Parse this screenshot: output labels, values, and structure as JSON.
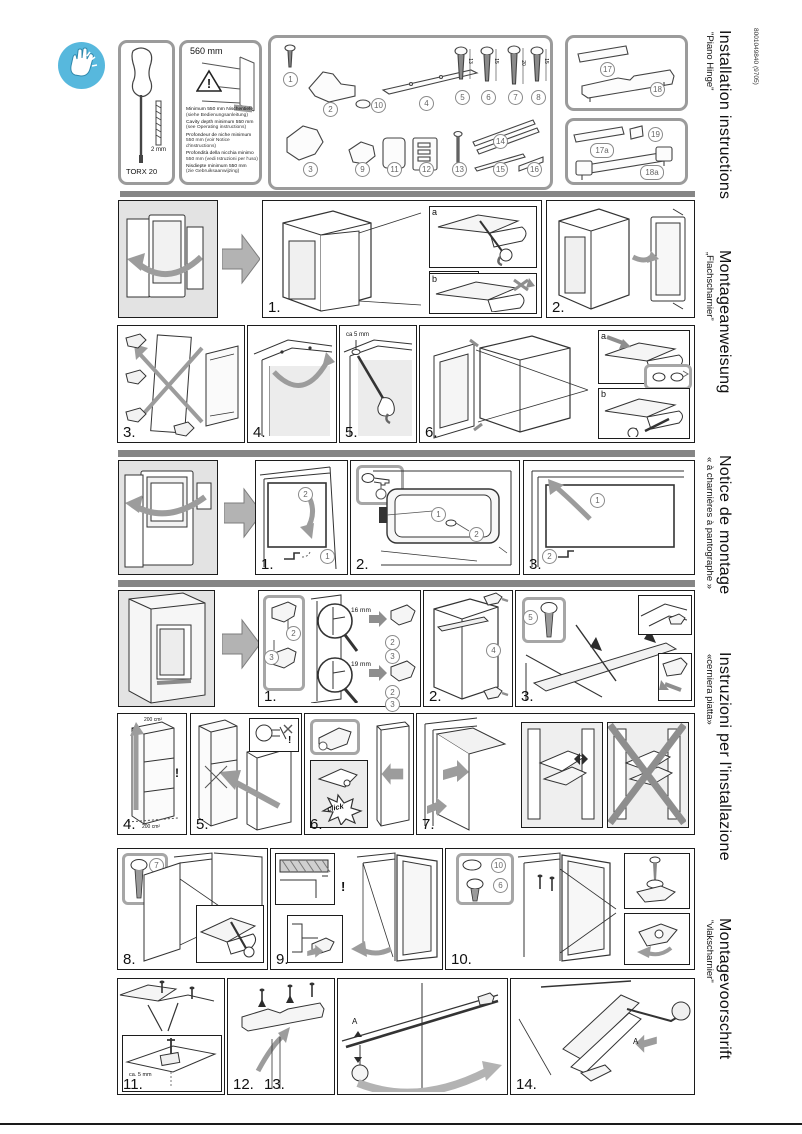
{
  "doc_code": "8001049840 (9705)",
  "languages": [
    {
      "title": "Installation instructions",
      "subtitle": "\"Piano Hinge\""
    },
    {
      "title": "Montageanweisung",
      "subtitle": "„Flachscharnier”"
    },
    {
      "title": "Notice de montage",
      "subtitle": "« à charnières à pantographe »"
    },
    {
      "title": "Instruzioni per l'installazione",
      "subtitle": "«cerniera piatta»"
    },
    {
      "title": "Montagevoorschrift",
      "subtitle": "\"vlakscharnier\""
    }
  ],
  "tool_panel": {
    "tool": "TORX 20",
    "bit": "2 mm"
  },
  "cavity_panel": {
    "dimension": "560 mm",
    "warning": "!",
    "requirements": [
      {
        "text": "Minimum 550 mm Nischentiefe",
        "note": "(siehe Bedienungsanleitung)"
      },
      {
        "text": "Cavity depth minimum 550 mm",
        "note": "(see Operating instructions)"
      },
      {
        "text": "Profondeur de niche minimum",
        "note": "550 mm (voir Notice d'instructions)"
      },
      {
        "text": "Profondità della nicchia minimo",
        "note": "550 mm (vedi Istruzioni per l'uso)"
      },
      {
        "text": "Nisdiepte minimum 550 mm",
        "note": "(zie Gebruiksaanwijzing)"
      }
    ]
  },
  "parts": {
    "p1": "1",
    "p2": "2",
    "p3": "3",
    "p4": "4",
    "p9": "9",
    "p10": "10",
    "p11": "11",
    "p12": "12",
    "p13": "13",
    "p14": "14",
    "p15": "15",
    "p16": "16",
    "screws": [
      {
        "no": "5",
        "len": "13"
      },
      {
        "no": "6",
        "len": "15"
      },
      {
        "no": "7",
        "len": "20"
      },
      {
        "no": "8",
        "len": "15"
      }
    ],
    "p17": "17",
    "p18": "18",
    "p17a": "17a",
    "p19": "19",
    "p18a": "18a"
  },
  "row1": {
    "step1": "1.",
    "step2": "2.",
    "inset_a": "a",
    "inset_b": "b",
    "check": "✓",
    "cross": "✗"
  },
  "row2": {
    "step3": "3.",
    "step4": "4.",
    "step5": "5.",
    "gap": "ca 5 mm",
    "step6": "6.",
    "inset_a": "a",
    "inset_b": "b"
  },
  "row3": {
    "step1": "1.",
    "step2": "2.",
    "step3": "3.",
    "ref1": "1",
    "ref2": "2"
  },
  "row4": {
    "step1": "1.",
    "step2": "2.",
    "step3": "3.",
    "dim16": "16 mm",
    "dim19": "19 mm",
    "ref2": "2",
    "ref3": "3",
    "ref4": "4",
    "ref5": "5"
  },
  "row5": {
    "step4": "4.",
    "step5": "5.",
    "step6": "6.",
    "step7": "7.",
    "area": "200 cm²",
    "warning": "!",
    "click": "click"
  },
  "row6": {
    "step8": "8.",
    "step9": "9.",
    "step10": "10.",
    "ref7": "7",
    "ref10": "10",
    "ref6": "6",
    "warning": "!"
  },
  "row7": {
    "step11": "11.",
    "step12": "12.",
    "step13": "13.",
    "step14": "14.",
    "gap": "ca. 5 mm",
    "dim_a": "A"
  }
}
